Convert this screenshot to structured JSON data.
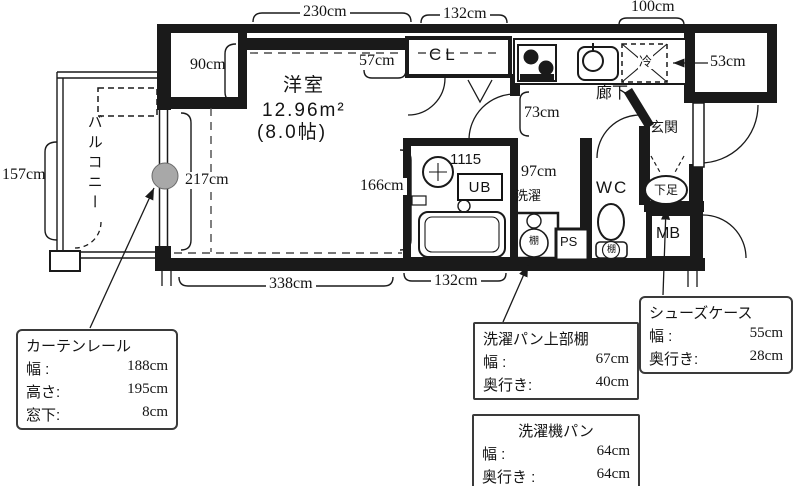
{
  "labels": {
    "balcony": "バルコニー",
    "room_name": "洋室",
    "room_area": "12.96m²",
    "room_tatami": "(8.0帖)",
    "closet": "CL",
    "hallway": "廊下",
    "entrance": "玄関",
    "wc": "WC",
    "mb": "MB",
    "ps": "PS",
    "ub": "UB",
    "ub_size": "1115",
    "laundry": "洗濯",
    "fridge": "冷",
    "shoe_storage": "下足",
    "shelf_washer": "棚",
    "shelf_toilet": "棚"
  },
  "dimensions": {
    "d230": "230cm",
    "d132_top": "132cm",
    "d100": "100cm",
    "d90": "90cm",
    "d57": "57cm",
    "d53": "53cm",
    "d73": "73cm",
    "d217": "217cm",
    "d166": "166cm",
    "d97": "97cm",
    "d157": "157cm",
    "d338": "338cm",
    "d132_bottom": "132cm"
  },
  "callouts": {
    "curtain_rail": {
      "title": "カーテンレール",
      "rows": [
        {
          "label": "幅 :",
          "value": "188cm"
        },
        {
          "label": "高さ:",
          "value": "195cm"
        },
        {
          "label": "窓下:",
          "value": "8cm"
        }
      ]
    },
    "laundry_shelf": {
      "title": "洗濯パン上部棚",
      "rows": [
        {
          "label": "幅 :",
          "value": "67cm"
        },
        {
          "label": "奥行き:",
          "value": "40cm"
        }
      ]
    },
    "washer_pan": {
      "title": "洗濯機パン",
      "rows": [
        {
          "label": "幅 :",
          "value": "64cm"
        },
        {
          "label": "奥行き :",
          "value": "64cm"
        }
      ]
    },
    "shoe_case": {
      "title": "シューズケース",
      "rows": [
        {
          "label": "幅 :",
          "value": "55cm"
        },
        {
          "label": "奥行き:",
          "value": "28cm"
        }
      ]
    }
  },
  "colors": {
    "wall": "#1a1a1a",
    "curtain_marker": "#a8a8a8"
  }
}
